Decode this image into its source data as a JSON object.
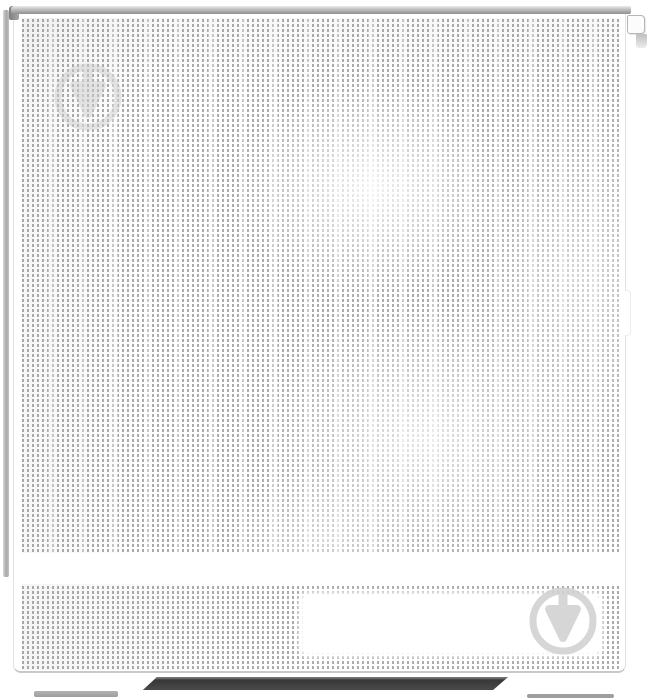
{
  "image": {
    "type": "product-photo",
    "subject": "White mid-tower PC case, front view, perforated mesh front panel with bottom vent strip, blank front plate, side-panel latch tab and two case feet",
    "visible_text": ""
  },
  "watermark": {
    "icon": "circle-down-arrow-logo-icon",
    "count": 2,
    "positions": [
      "top-left",
      "bottom-right"
    ]
  },
  "colors": {
    "background": "#ffffff",
    "mesh_dot": "#ababab",
    "bezel_line": "#e2e2e2",
    "top_edge_light": "#ececec",
    "top_edge_dark": "#8f8f8f",
    "side_strip": "#a8a8a8",
    "shadow_bar": "#383838",
    "foot_pad": "#9e9e9e",
    "watermark": "#cdcdcd"
  }
}
